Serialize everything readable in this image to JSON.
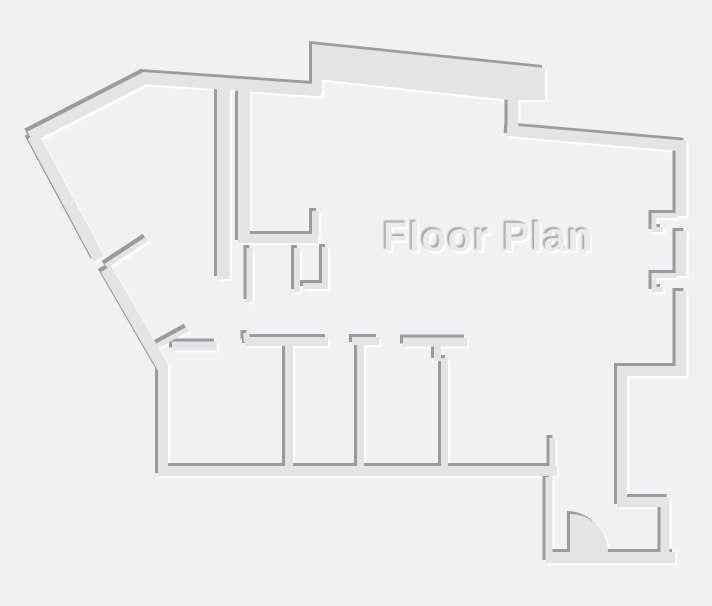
{
  "title": "Floor Plan",
  "colors": {
    "background": "#f0f1f2",
    "wall_fill": "#e2e4e5",
    "shadow": "#9b9b9b",
    "highlight": "#ffffff",
    "title_fill": "#e8eaeb",
    "title_shadow": "#a9a9a9"
  }
}
